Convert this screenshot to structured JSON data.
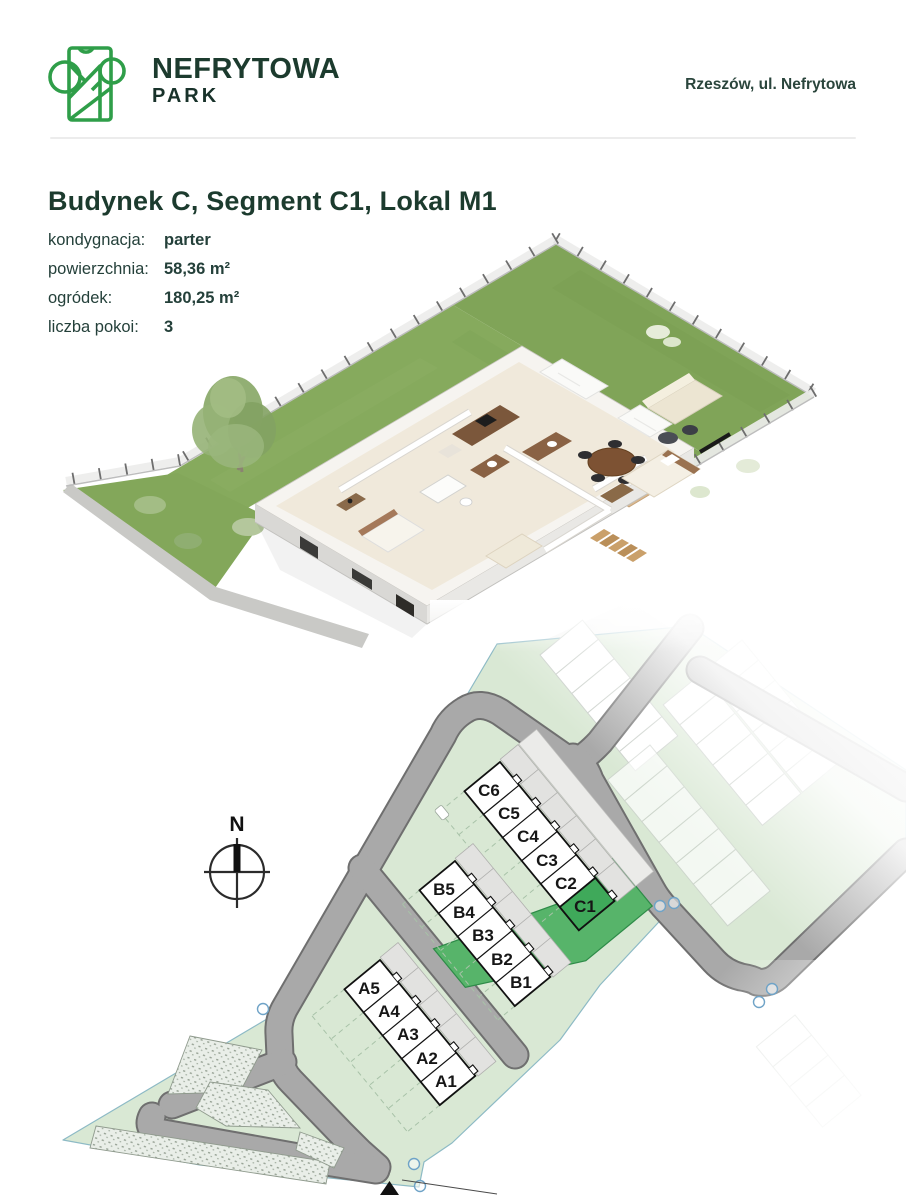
{
  "header": {
    "brand_top": "NEFRYTOWA",
    "brand_bottom": "PARK",
    "location": "Rzeszów, ul. Nefrytowa"
  },
  "page": {
    "title": "Budynek C, Segment C1, Lokal M1"
  },
  "details": {
    "rows": [
      {
        "label": "kondygnacja:",
        "value": "parter"
      },
      {
        "label": "powierzchnia:",
        "value": "58,36 m²"
      },
      {
        "label": "ogródek:",
        "value": "180,25 m²"
      },
      {
        "label": "liczba pokoi:",
        "value": "3"
      }
    ]
  },
  "site_plan": {
    "compass": "N",
    "highlighted_segment": "C1",
    "rows": {
      "a": [
        "A5",
        "A4",
        "A3",
        "A2",
        "A1"
      ],
      "b": [
        "B5",
        "B4",
        "B3",
        "B2",
        "B1"
      ],
      "c": [
        "C6",
        "C5",
        "C4",
        "C3",
        "C2",
        "C1"
      ]
    },
    "colors": {
      "brand_green": "#2f9e49",
      "heading_green": "#1c3b2e",
      "estate_green": "#d8e8d3",
      "highlight_plot": "#57b46a",
      "highlight_building": "#3fa95a",
      "road_gray": "#a9a9a9",
      "grass_green": "#80a458"
    }
  }
}
